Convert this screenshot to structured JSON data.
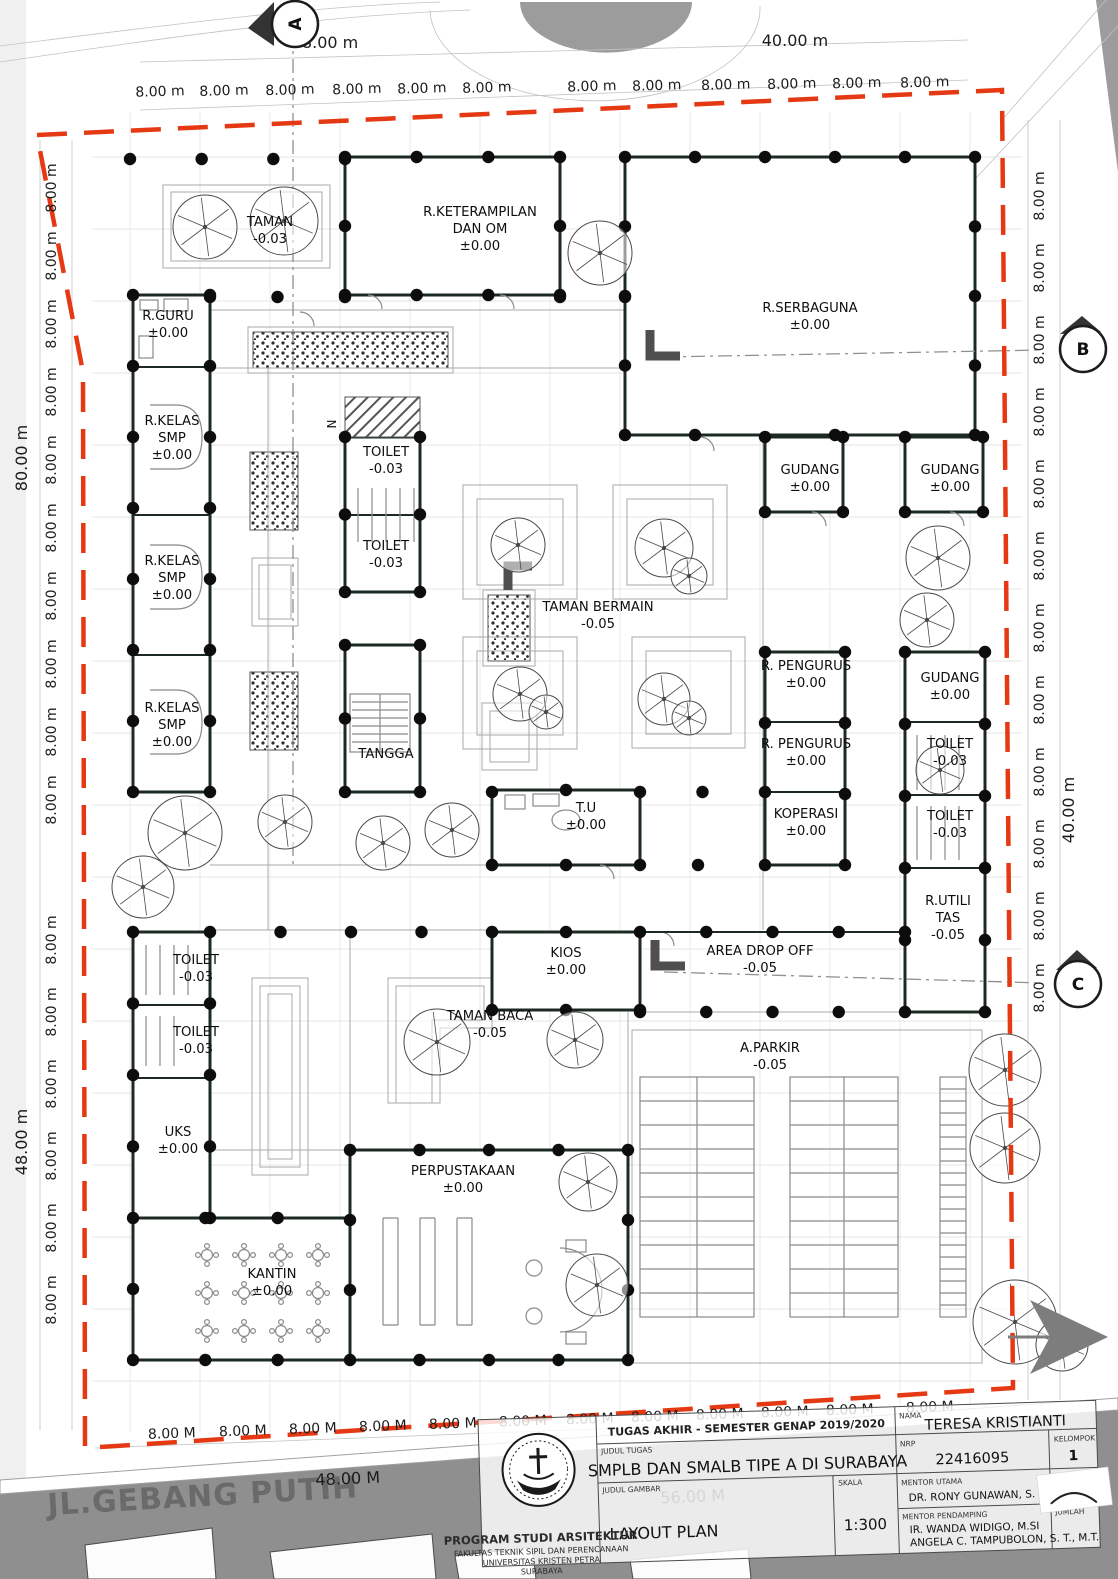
{
  "plan": {
    "street_label": "JL.GEBANG PUTIH",
    "north_label": "N",
    "rooms": [
      {
        "lines": [
          "TAMAN"
        ],
        "level": "-0.03",
        "x": 270,
        "y": 226
      },
      {
        "lines": [
          "R.KETERAMPILAN",
          "DAN OM"
        ],
        "level": "±0.00",
        "x": 480,
        "y": 216
      },
      {
        "lines": [
          "R.SERBAGUNA"
        ],
        "level": "±0.00",
        "x": 810,
        "y": 312
      },
      {
        "lines": [
          "R.GURU"
        ],
        "level": "±0.00",
        "x": 168,
        "y": 320
      },
      {
        "lines": [
          "R.KELAS",
          "SMP"
        ],
        "level": "±0.00",
        "x": 172,
        "y": 425
      },
      {
        "lines": [
          "R.KELAS",
          "SMP"
        ],
        "level": "±0.00",
        "x": 172,
        "y": 565
      },
      {
        "lines": [
          "R.KELAS",
          "SMP"
        ],
        "level": "±0.00",
        "x": 172,
        "y": 712
      },
      {
        "lines": [
          "TOILET"
        ],
        "level": "-0.03",
        "x": 386,
        "y": 456
      },
      {
        "lines": [
          "TOILET"
        ],
        "level": "-0.03",
        "x": 386,
        "y": 550
      },
      {
        "lines": [
          "TAMAN BERMAIN"
        ],
        "level": "-0.05",
        "x": 598,
        "y": 611
      },
      {
        "lines": [
          "GUDANG"
        ],
        "level": "±0.00",
        "x": 810,
        "y": 474
      },
      {
        "lines": [
          "GUDANG"
        ],
        "level": "±0.00",
        "x": 950,
        "y": 474
      },
      {
        "lines": [
          "R. PENGURUS"
        ],
        "level": "±0.00",
        "x": 806,
        "y": 670
      },
      {
        "lines": [
          "R. PENGURUS"
        ],
        "level": "±0.00",
        "x": 806,
        "y": 748
      },
      {
        "lines": [
          "KOPERASI"
        ],
        "level": "±0.00",
        "x": 806,
        "y": 818
      },
      {
        "lines": [
          "GUDANG"
        ],
        "level": "±0.00",
        "x": 950,
        "y": 682
      },
      {
        "lines": [
          "TOILET"
        ],
        "level": "-0.03",
        "x": 950,
        "y": 748
      },
      {
        "lines": [
          "TOILET"
        ],
        "level": "-0.03",
        "x": 950,
        "y": 820
      },
      {
        "lines": [
          "R.UTILI",
          "TAS"
        ],
        "level": "-0.05",
        "x": 948,
        "y": 905
      },
      {
        "lines": [
          "TANGGA"
        ],
        "level": "",
        "x": 386,
        "y": 758
      },
      {
        "lines": [
          "T.U"
        ],
        "level": "±0.00",
        "x": 586,
        "y": 812
      },
      {
        "lines": [
          "KIOS"
        ],
        "level": "±0.00",
        "x": 566,
        "y": 957
      },
      {
        "lines": [
          "AREA DROP OFF"
        ],
        "level": "-0.05",
        "x": 760,
        "y": 955
      },
      {
        "lines": [
          "TOILET"
        ],
        "level": "-0.03",
        "x": 196,
        "y": 964
      },
      {
        "lines": [
          "TOILET"
        ],
        "level": "-0.03",
        "x": 196,
        "y": 1036
      },
      {
        "lines": [
          "UKS"
        ],
        "level": "±0.00",
        "x": 178,
        "y": 1136
      },
      {
        "lines": [
          "TAMAN BACA"
        ],
        "level": "-0.05",
        "x": 490,
        "y": 1020
      },
      {
        "lines": [
          "A.PARKIR"
        ],
        "level": "-0.05",
        "x": 770,
        "y": 1052
      },
      {
        "lines": [
          "KANTIN"
        ],
        "level": "±0.00",
        "x": 272,
        "y": 1278
      },
      {
        "lines": [
          "PERPUSTAKAAN"
        ],
        "level": "±0.00",
        "x": 463,
        "y": 1175
      }
    ]
  },
  "dimensions": {
    "unit_top": "8.00 m",
    "unit_left": "8.00 m",
    "unit_right": "8.00 m",
    "unit_bottom": "8.00 M",
    "top_overall": [
      {
        "text": "48.00 m"
      },
      {
        "text": "40.00 m"
      }
    ],
    "left_overall": [
      {
        "text": "80.00 m"
      },
      {
        "text": "48.00 m"
      }
    ],
    "right_overall": [
      {
        "text": "40.00 m"
      }
    ],
    "bottom_overall": [
      {
        "text": "48.00 M"
      },
      {
        "text": "56.00 M"
      }
    ]
  },
  "section_markers": [
    {
      "label": "A"
    },
    {
      "label": "B"
    },
    {
      "label": "C"
    }
  ],
  "title_block": {
    "header": "TUGAS AKHIR - SEMESTER GENAP 2019/2020",
    "labels": {
      "judul_tugas": "JUDUL TUGAS",
      "judul_gambar": "JUDUL GAMBAR",
      "skala": "SKALA",
      "nama": "NAMA",
      "nrp": "NRP",
      "kelompok": "KELOMPOK",
      "mentor_utama": "MENTOR UTAMA",
      "mentor_pendamping": "MENTOR PENDAMPING",
      "paraf": "PARAF",
      "jumlah": "JUMLAH"
    },
    "values": {
      "judul_tugas": "SMPLB DAN SMALB TIPE A DI SURABAYA",
      "judul_gambar": "LAYOUT PLAN",
      "skala": "1:300",
      "nama": "TERESA KRISTIANTI",
      "nrp": "22416095",
      "kelompok": "1",
      "mentor_utama": "DR. RONY GUNAWAN, S. T., M.T.",
      "mentor_pendamping_1": "IR. WANDA WIDIGO, M.SI",
      "mentor_pendamping_2": "ANGELA C. TAMPUBOLON, S. T., M.T."
    },
    "institution": [
      "PROGRAM STUDI ARSITEKTUR",
      "FAKULTAS TEKNIK SIPIL DAN PERENCANAAN",
      "UNIVERSITAS KRISTEN PETRA",
      "SURABAYA"
    ]
  },
  "colors": {
    "boundary": "#e53914",
    "wall": "#1c2a22",
    "road": "#8f8f8f",
    "column_dot": "#0d0d0d"
  }
}
